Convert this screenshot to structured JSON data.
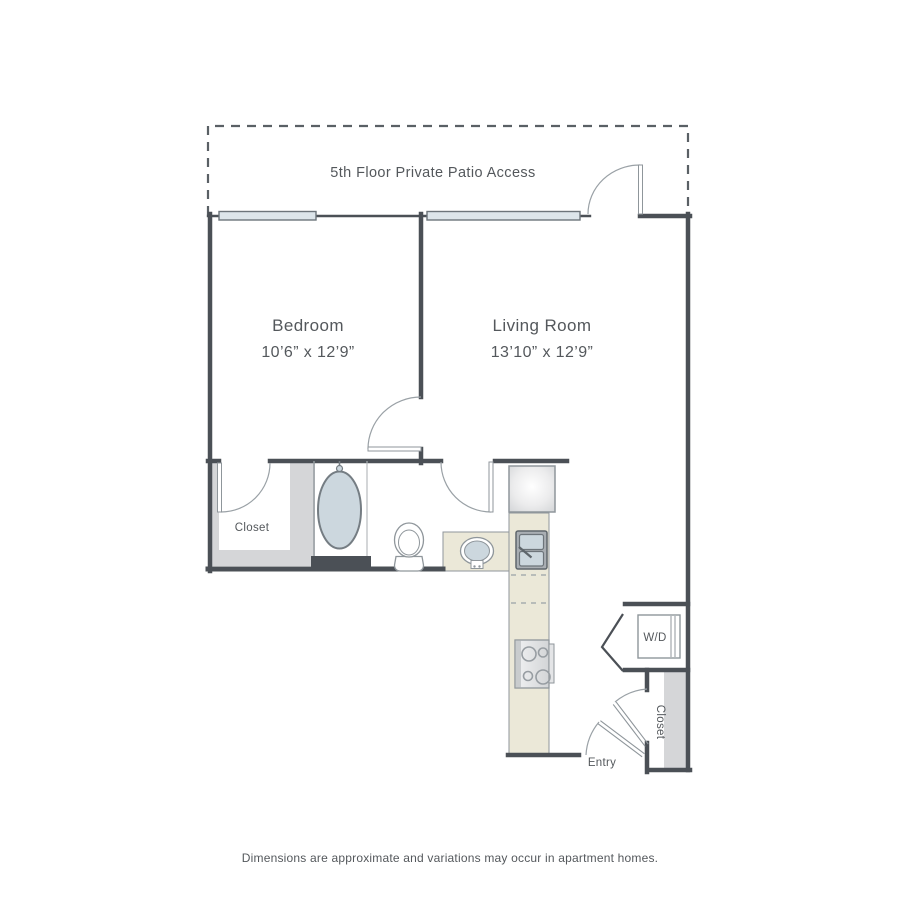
{
  "patio": {
    "label": "5th Floor Private Patio Access"
  },
  "rooms": {
    "bedroom": {
      "name": "Bedroom",
      "dimensions": "10’6” x 12’9”"
    },
    "living_room": {
      "name": "Living Room",
      "dimensions": "13’10” x 12’9”"
    }
  },
  "labels": {
    "bedroom_closet": "Closet",
    "entry_closet": "Closet",
    "laundry": "W/D",
    "entry": "Entry"
  },
  "footer": {
    "note": "Dimensions are approximate and variations may occur in apartment homes."
  },
  "colors": {
    "wall": "#4b5056",
    "thin_line": "#8f969b",
    "window_fill": "#dde5ea",
    "fixture_fill": "#ccd7de",
    "counter_fill": "#ebe8d8",
    "shelf_gray": "#d5d6d8",
    "text": "#54585c"
  }
}
